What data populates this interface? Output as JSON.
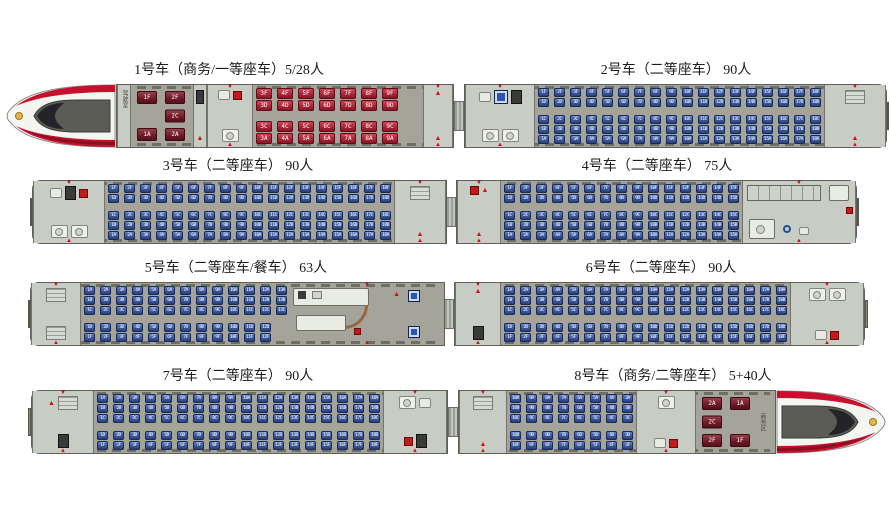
{
  "diagram": {
    "name": "train-seat-map",
    "background": "#ffffff"
  },
  "colors": {
    "second_class_seat": "#3a579a",
    "first_class_seat": "#a82034",
    "business_seat": "#6d1a26",
    "car_body": "#a4a49b",
    "vestibule": "#c7ccc5",
    "nose_red_stripe": "#c8102e",
    "marker_red": "#cf0a18"
  },
  "rows": [
    {
      "top": 60,
      "left": 4,
      "cars": [
        {
          "num": 1,
          "title": "1号车（商务/一等座车）5/28人",
          "width": 450,
          "nose": "left",
          "sections": [
            {
              "t": "vest",
              "w": 14,
              "top": [
                "label:驾驶室"
              ],
              "bot": []
            },
            {
              "t": "biz",
              "w": 62,
              "cols": [
                {
                  "top": "1F",
                  "bottom": "1A"
                },
                {
                  "top": "2F",
                  "mid": "2C",
                  "bottom": "2A"
                }
              ]
            },
            {
              "t": "vest",
              "w": 14,
              "top": [
                "equip"
              ],
              "bot": [
                "person"
              ]
            },
            {
              "t": "vest",
              "w": 46,
              "top": [
                "sink",
                "red"
              ],
              "bot": [
                "toilet"
              ],
              "door": true
            },
            {
              "t": "seats",
              "w": 170,
              "cls": "first",
              "from": 3,
              "to": 9,
              "top": [
                "F",
                "D"
              ],
              "bot": [
                "C",
                "A"
              ]
            },
            {
              "t": "vest",
              "w": 30,
              "top": [
                "person"
              ],
              "bot": [
                "person"
              ],
              "door": true
            }
          ]
        },
        {
          "num": 2,
          "title": "2号车（二等座车） 90人",
          "width": 424,
          "end": "right",
          "sections": [
            {
              "t": "vest",
              "w": 70,
              "top": [
                "sink",
                "vending",
                "equip"
              ],
              "bot": [
                "toilet",
                "toilet"
              ],
              "door": true
            },
            {
              "t": "seats",
              "w": 289,
              "cls": "second",
              "from": 1,
              "to": 18,
              "top": [
                "F",
                "D"
              ],
              "bot": [
                "C",
                "B",
                "A"
              ]
            },
            {
              "t": "vest",
              "w": 62,
              "top": [
                "luggage"
              ],
              "bot": [
                "person"
              ],
              "door": true
            }
          ]
        }
      ]
    },
    {
      "top": 156,
      "left": 30,
      "cars": [
        {
          "num": 3,
          "title": "3号车（二等座车） 90人",
          "width": 416,
          "end": "left",
          "sections": [
            {
              "t": "vest",
              "w": 72,
              "top": [
                "sink",
                "equip",
                "red"
              ],
              "bot": [
                "toilet",
                "toilet"
              ],
              "door": true
            },
            {
              "t": "seats",
              "w": 289,
              "cls": "second",
              "from": 1,
              "to": 18,
              "top": [
                "F",
                "D"
              ],
              "bot": [
                "C",
                "B",
                "A"
              ]
            },
            {
              "t": "vest",
              "w": 52,
              "top": [
                "luggage"
              ],
              "bot": [
                "person"
              ],
              "door": true
            }
          ]
        },
        {
          "num": 4,
          "title": "4号车（二等座车） 75人",
          "width": 402,
          "end": "right",
          "sections": [
            {
              "t": "vest",
              "w": 44,
              "top": [
                "red",
                "person"
              ],
              "bot": [
                "person"
              ],
              "door": true
            },
            {
              "t": "seats",
              "w": 241,
              "cls": "second",
              "from": 1,
              "to": 15,
              "top": [
                "F",
                "D"
              ],
              "bot": [
                "C",
                "B",
                "A"
              ]
            },
            {
              "t": "access",
              "w": 114
            }
          ]
        }
      ]
    },
    {
      "top": 258,
      "left": 28,
      "cars": [
        {
          "num": 5,
          "title": "5号车（二等座车/餐车） 63人",
          "width": 416,
          "end": "left",
          "sections": [
            {
              "t": "vest",
              "w": 50,
              "top": [
                "luggage"
              ],
              "bot": [
                "luggage"
              ],
              "door": true
            },
            {
              "t": "seats",
              "w": 209,
              "cls": "second",
              "from": 1,
              "to": 13,
              "botN": 12,
              "top": [
                "A",
                "B",
                "C"
              ],
              "bot": [
                "D",
                "F"
              ]
            },
            {
              "t": "dining",
              "w": 154
            }
          ]
        },
        {
          "num": 6,
          "title": "6号车（二等座车） 90人",
          "width": 414,
          "end": "right",
          "sections": [
            {
              "t": "vest",
              "w": 46,
              "top": [
                "person"
              ],
              "bot": [
                "equip"
              ],
              "door": true
            },
            {
              "t": "seats",
              "w": 289,
              "cls": "second",
              "from": 1,
              "to": 18,
              "top": [
                "A",
                "B",
                "C"
              ],
              "bot": [
                "D",
                "F"
              ]
            },
            {
              "t": "vest",
              "w": 74,
              "top": [
                "toilet",
                "toilet"
              ],
              "bot": [
                "sink",
                "red"
              ],
              "door": true
            }
          ]
        }
      ]
    },
    {
      "top": 366,
      "left": 28,
      "cars": [
        {
          "num": 7,
          "title": "7号车（二等座车） 90人",
          "width": 420,
          "end": "left",
          "sections": [
            {
              "t": "vest",
              "w": 62,
              "top": [
                "person",
                "luggage"
              ],
              "bot": [
                "equip"
              ],
              "door": true
            },
            {
              "t": "seats",
              "w": 289,
              "cls": "second",
              "from": 1,
              "to": 18,
              "top": [
                "A",
                "B",
                "C"
              ],
              "bot": [
                "D",
                "F"
              ]
            },
            {
              "t": "vest",
              "w": 64,
              "top": [
                "toilet",
                "sink"
              ],
              "bot": [
                "red",
                "equip"
              ],
              "door": true
            }
          ]
        },
        {
          "num": 8,
          "title": "8号车（商务/二等座车） 5+40人",
          "width": 430,
          "nose": "right",
          "sections": [
            {
              "t": "vest",
              "w": 48,
              "top": [
                "luggage"
              ],
              "bot": [
                "person"
              ],
              "door": true
            },
            {
              "t": "seats",
              "w": 129,
              "cls": "second",
              "from": 3,
              "to": 10,
              "desc": true,
              "top": [
                "A",
                "B",
                "C"
              ],
              "bot": [
                "D",
                "F"
              ]
            },
            {
              "t": "vest",
              "w": 60,
              "top": [
                "toilet"
              ],
              "bot": [
                "sink",
                "red"
              ],
              "door": true
            },
            {
              "t": "biz",
              "w": 76,
              "label": "商务区",
              "cols": [
                {
                  "top": "2A",
                  "mid": "2C",
                  "bottom": "2F"
                },
                {
                  "top": "1A",
                  "bottom": "1F"
                }
              ]
            }
          ]
        }
      ]
    }
  ]
}
